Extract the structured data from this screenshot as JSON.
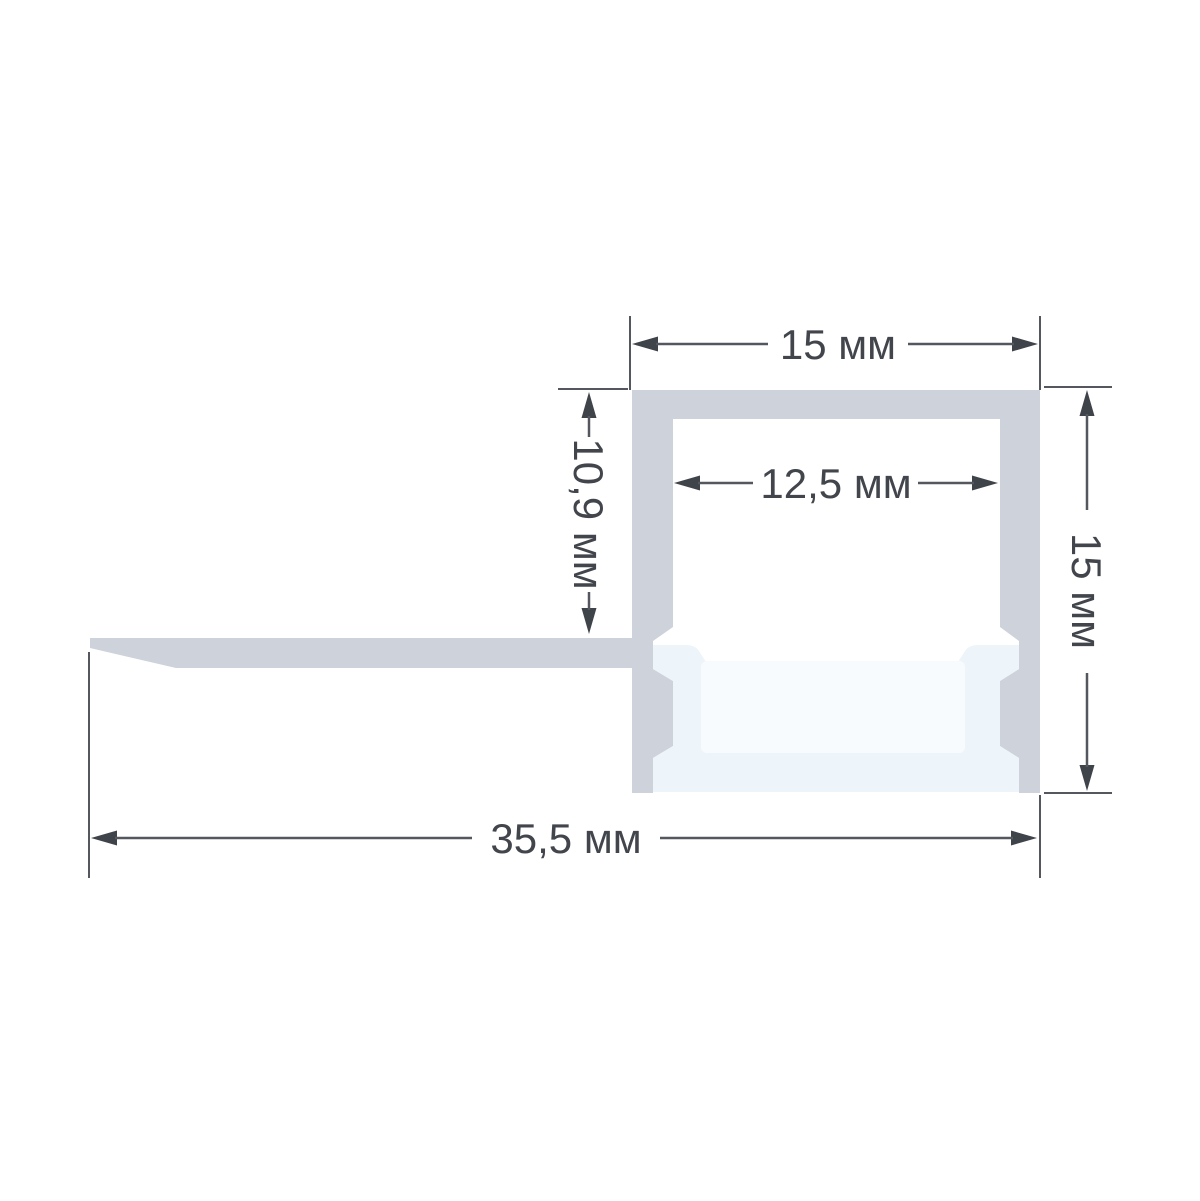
{
  "drawing": {
    "type": "led-profile-cross-section",
    "unit": "мм",
    "dimensions": {
      "top_width": {
        "label": "15 мм",
        "value": 15
      },
      "inner_width": {
        "label": "12,5 мм",
        "value": 12.5
      },
      "flange_drop": {
        "label": "10,9 мм",
        "value": 10.9
      },
      "side_height": {
        "label": "15 мм",
        "value": 15
      },
      "total_width": {
        "label": "35,5 мм",
        "value": 35.5
      }
    },
    "colors": {
      "aluminum": "#cdd2db",
      "diffuser": "#edf4fa",
      "diffuser_highlight": "#f8fbfd",
      "dimension_lines": "#54585e",
      "text": "#42464c",
      "background": "#ffffff"
    }
  }
}
